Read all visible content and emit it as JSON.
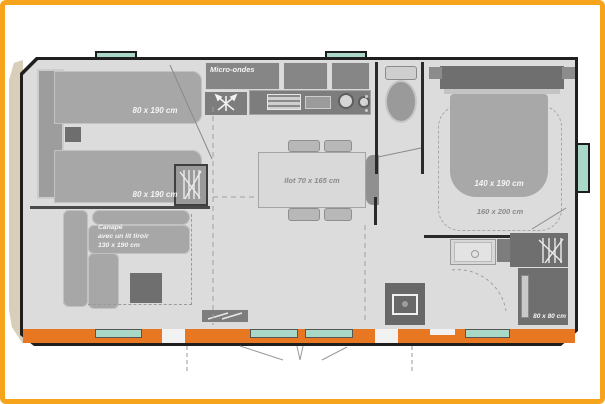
{
  "meta": {
    "type": "mobile-home floor plan",
    "language": "fr"
  },
  "colors": {
    "frame_orange": "#F5A41C",
    "deck_orange": "#E87722",
    "window_teal": "#A9D8C8",
    "wall_black": "#1F1F1F",
    "floor_gray": "#DCDCDC",
    "furniture_gray": "#A7A7A7",
    "furniture_dark": "#6F6F6F",
    "kitchen_gray": "#7D7D7D",
    "label_white": "#F5F5F5",
    "label_gray": "#8A8A8A"
  },
  "rooms": {
    "kitchen": {
      "microwave_label": "Micro-ondes"
    },
    "bedroom_twin": {
      "bed_top_label": "80 x 190 cm",
      "bed_bottom_label": "80 x 190 cm"
    },
    "living": {
      "sofa_label_line1": "Canapé",
      "sofa_label_line2": "avec un lit tiroir",
      "sofa_label_line3": "130 x 190 cm"
    },
    "dining": {
      "island_label": "Ilot 70 x 165 cm"
    },
    "bedroom_master": {
      "bed_label": "140 x 190 cm",
      "zone_label": "160 x 200 cm"
    },
    "bathroom": {
      "shower_label": "80 x 80 cm"
    }
  },
  "icons": {
    "extractor-hood-icon": "crossed fan blades",
    "toilet-icon": "toilet top view",
    "washbasin-icon": "basin with drain",
    "hangers-icon": "clothes rail strokes",
    "water-heater-icon": "boiler box with dot",
    "entry-step-icon": "striped door mat"
  }
}
